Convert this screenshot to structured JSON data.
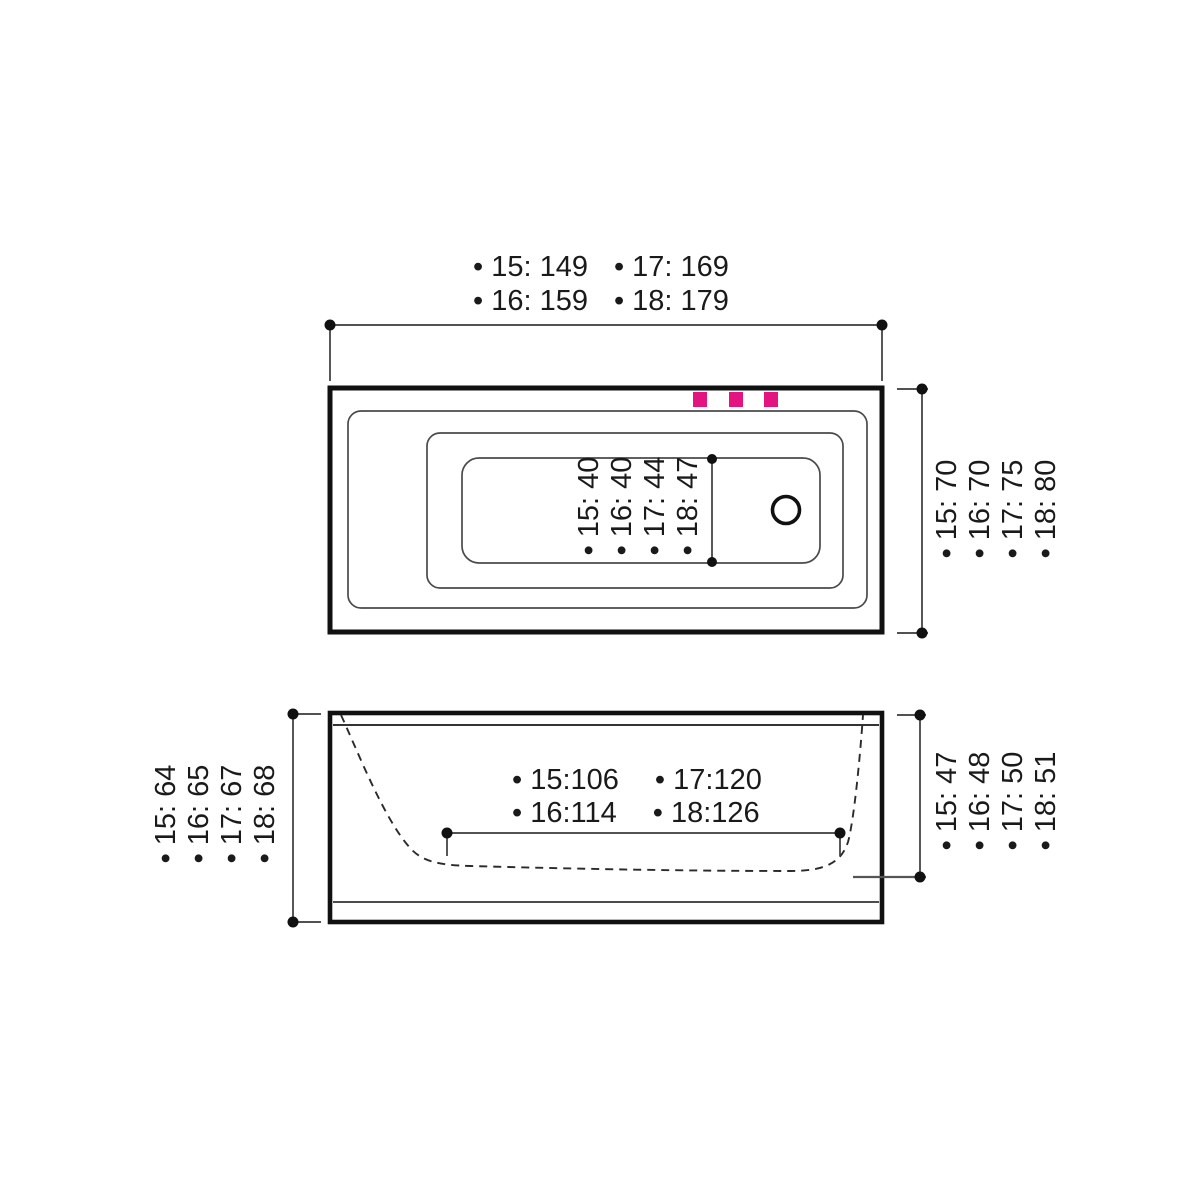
{
  "colors": {
    "ink": "#1a1a1a",
    "line": "#3a3a3a",
    "accent": "#e3147f"
  },
  "top_view": {
    "overall_length": {
      "row1": [
        "• 15: 149",
        "• 17: 169"
      ],
      "row2": [
        "• 16: 159",
        "• 18: 179"
      ]
    },
    "overall_width": [
      "• 15: 70",
      "• 16: 70",
      "• 17: 75",
      "• 18: 80"
    ],
    "floor_width": [
      "• 15: 40",
      "• 16: 40",
      "• 17: 44",
      "• 18: 47"
    ]
  },
  "side_view": {
    "overall_height": [
      "• 15: 64",
      "• 16: 65",
      "• 17: 67",
      "• 18: 68"
    ],
    "inner_depth": [
      "• 15: 47",
      "• 16: 48",
      "• 17: 50",
      "• 18: 51"
    ],
    "floor_length": {
      "row1": [
        "• 15:106",
        "• 17:120"
      ],
      "row2": [
        "• 16:114",
        "• 18:126"
      ]
    }
  }
}
